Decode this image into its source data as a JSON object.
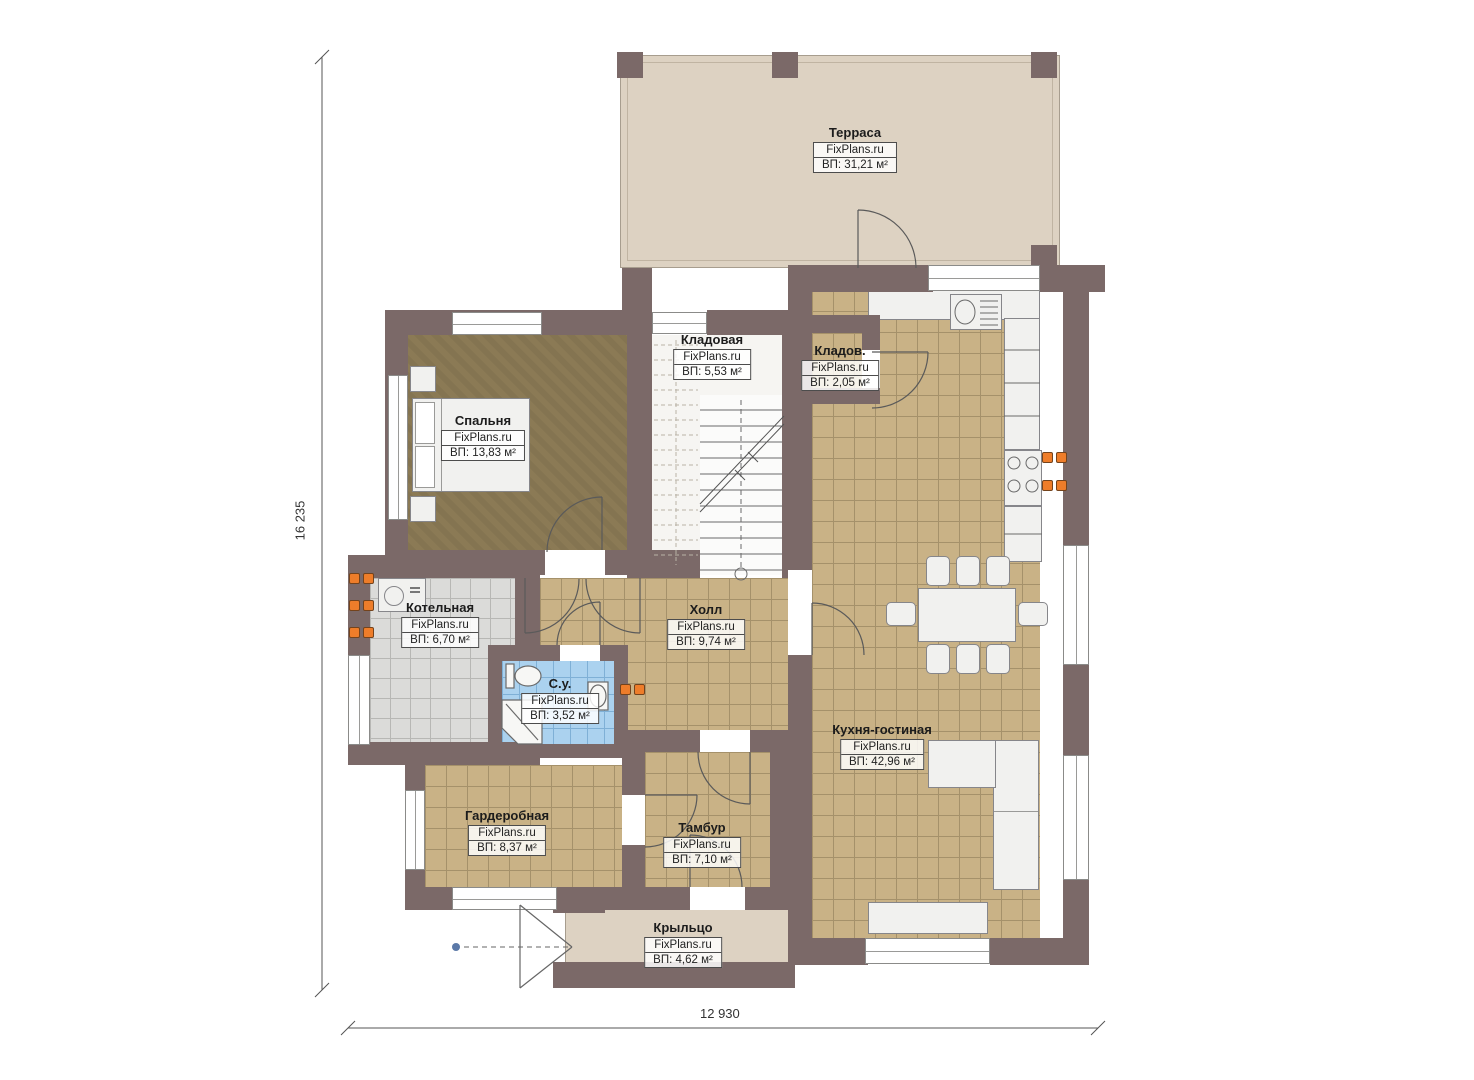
{
  "plan": {
    "title": "План 1 этажа",
    "watermark": "FixPlans.ru",
    "rooms": [
      {
        "id": "terrace",
        "name": "Терраса",
        "watermark": "FixPlans.ru",
        "area": "ВП: 31,21 м²"
      },
      {
        "id": "storage",
        "name": "Кладовая",
        "watermark": "FixPlans.ru",
        "area": "ВП: 5,53 м²"
      },
      {
        "id": "storage2",
        "name": "Кладов.",
        "watermark": "FixPlans.ru",
        "area": "ВП: 2,05 м²"
      },
      {
        "id": "bedroom",
        "name": "Спальня",
        "watermark": "FixPlans.ru",
        "area": "ВП: 13,83 м²"
      },
      {
        "id": "boiler",
        "name": "Котельная",
        "watermark": "FixPlans.ru",
        "area": "ВП: 6,70 м²"
      },
      {
        "id": "hall",
        "name": "Холл",
        "watermark": "FixPlans.ru",
        "area": "ВП: 9,74 м²"
      },
      {
        "id": "bathroom",
        "name": "С.у.",
        "watermark": "FixPlans.ru",
        "area": "ВП: 3,52 м²"
      },
      {
        "id": "kitchen",
        "name": "Кухня-гостиная",
        "watermark": "FixPlans.ru",
        "area": "ВП: 42,96 м²"
      },
      {
        "id": "wardrobe",
        "name": "Гардеробная",
        "watermark": "FixPlans.ru",
        "area": "ВП: 8,37 м²"
      },
      {
        "id": "vestibule",
        "name": "Тамбур",
        "watermark": "FixPlans.ru",
        "area": "ВП: 7,10 м²"
      },
      {
        "id": "porch",
        "name": "Крыльцо",
        "watermark": "FixPlans.ru",
        "area": "ВП: 4,62 м²"
      }
    ],
    "dimensions": {
      "height": "16 235",
      "width": "12 930"
    },
    "colors": {
      "wall": "#7b6968",
      "terrace_floor": "#ddd2c2",
      "tile_tan": "#c9b286",
      "tile_gray": "#dbdbd9",
      "tile_blue": "#abd2ef",
      "carpet": "#8b7a55",
      "burner_orange": "#ee7d2a",
      "line": "#555555"
    }
  }
}
